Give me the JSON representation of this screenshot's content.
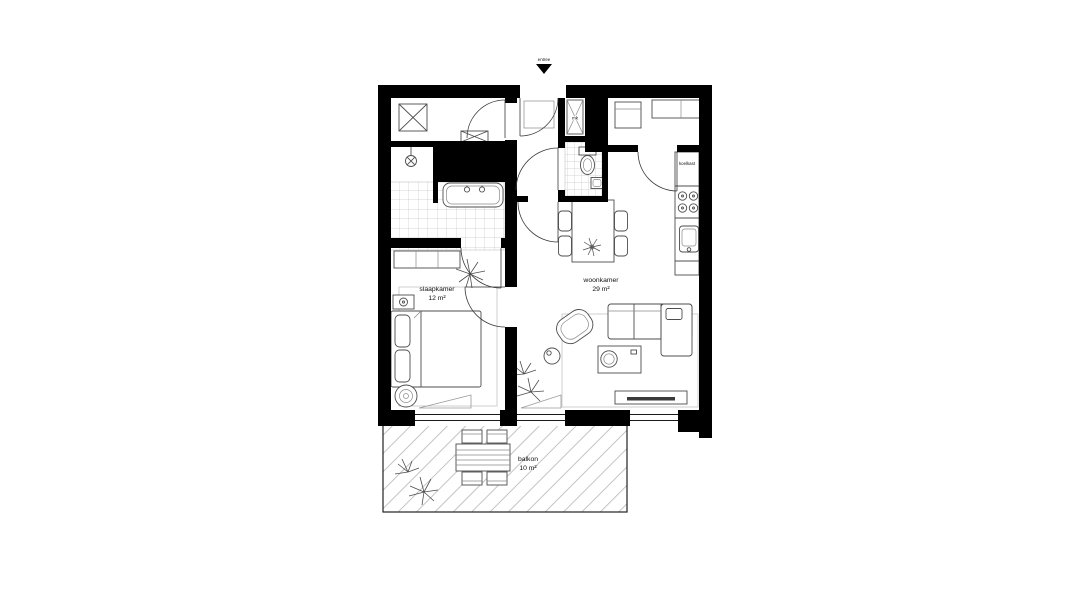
{
  "plan": {
    "type": "apartment-floor-plan",
    "style": "black-and-white architectural drawing",
    "entrance": {
      "label": "entree"
    },
    "rooms": {
      "bedroom": {
        "name": "slaapkamer",
        "area": "12 m²"
      },
      "living": {
        "name": "woonkamer",
        "area": "29 m²"
      },
      "balcony": {
        "name": "balkon",
        "area": "10 m²"
      }
    },
    "closets": {
      "meter_cupboard": "mk"
    },
    "kitchen": {
      "fridge_label": "koelkast"
    },
    "icons": {
      "entrance-arrow-icon": "solid downward triangle marking the front door",
      "washing-machine-icon": "square with X",
      "doormat-icon": "rectangle with X",
      "bathtub-icon": "rounded tub with two taps",
      "ceiling-lamp-icon": "circle with X on a stem",
      "toilet-icon": "cistern with oval bowl",
      "stove-icon": "four burner circles",
      "sink-icon": "rounded basin",
      "plant-icon": "radiating leaves",
      "bed-icon": "double bed with two pillows",
      "sofa-icon": "L-shaped corner sofa",
      "tv-icon": "lowboard with screen line"
    },
    "colors": {
      "wall": "#000000",
      "fixture_line": "#4d4d4d",
      "tile_line": "#c9c9c9",
      "hatch_line": "#b5b5b5",
      "label_text": "#111111",
      "background": "#ffffff"
    }
  }
}
